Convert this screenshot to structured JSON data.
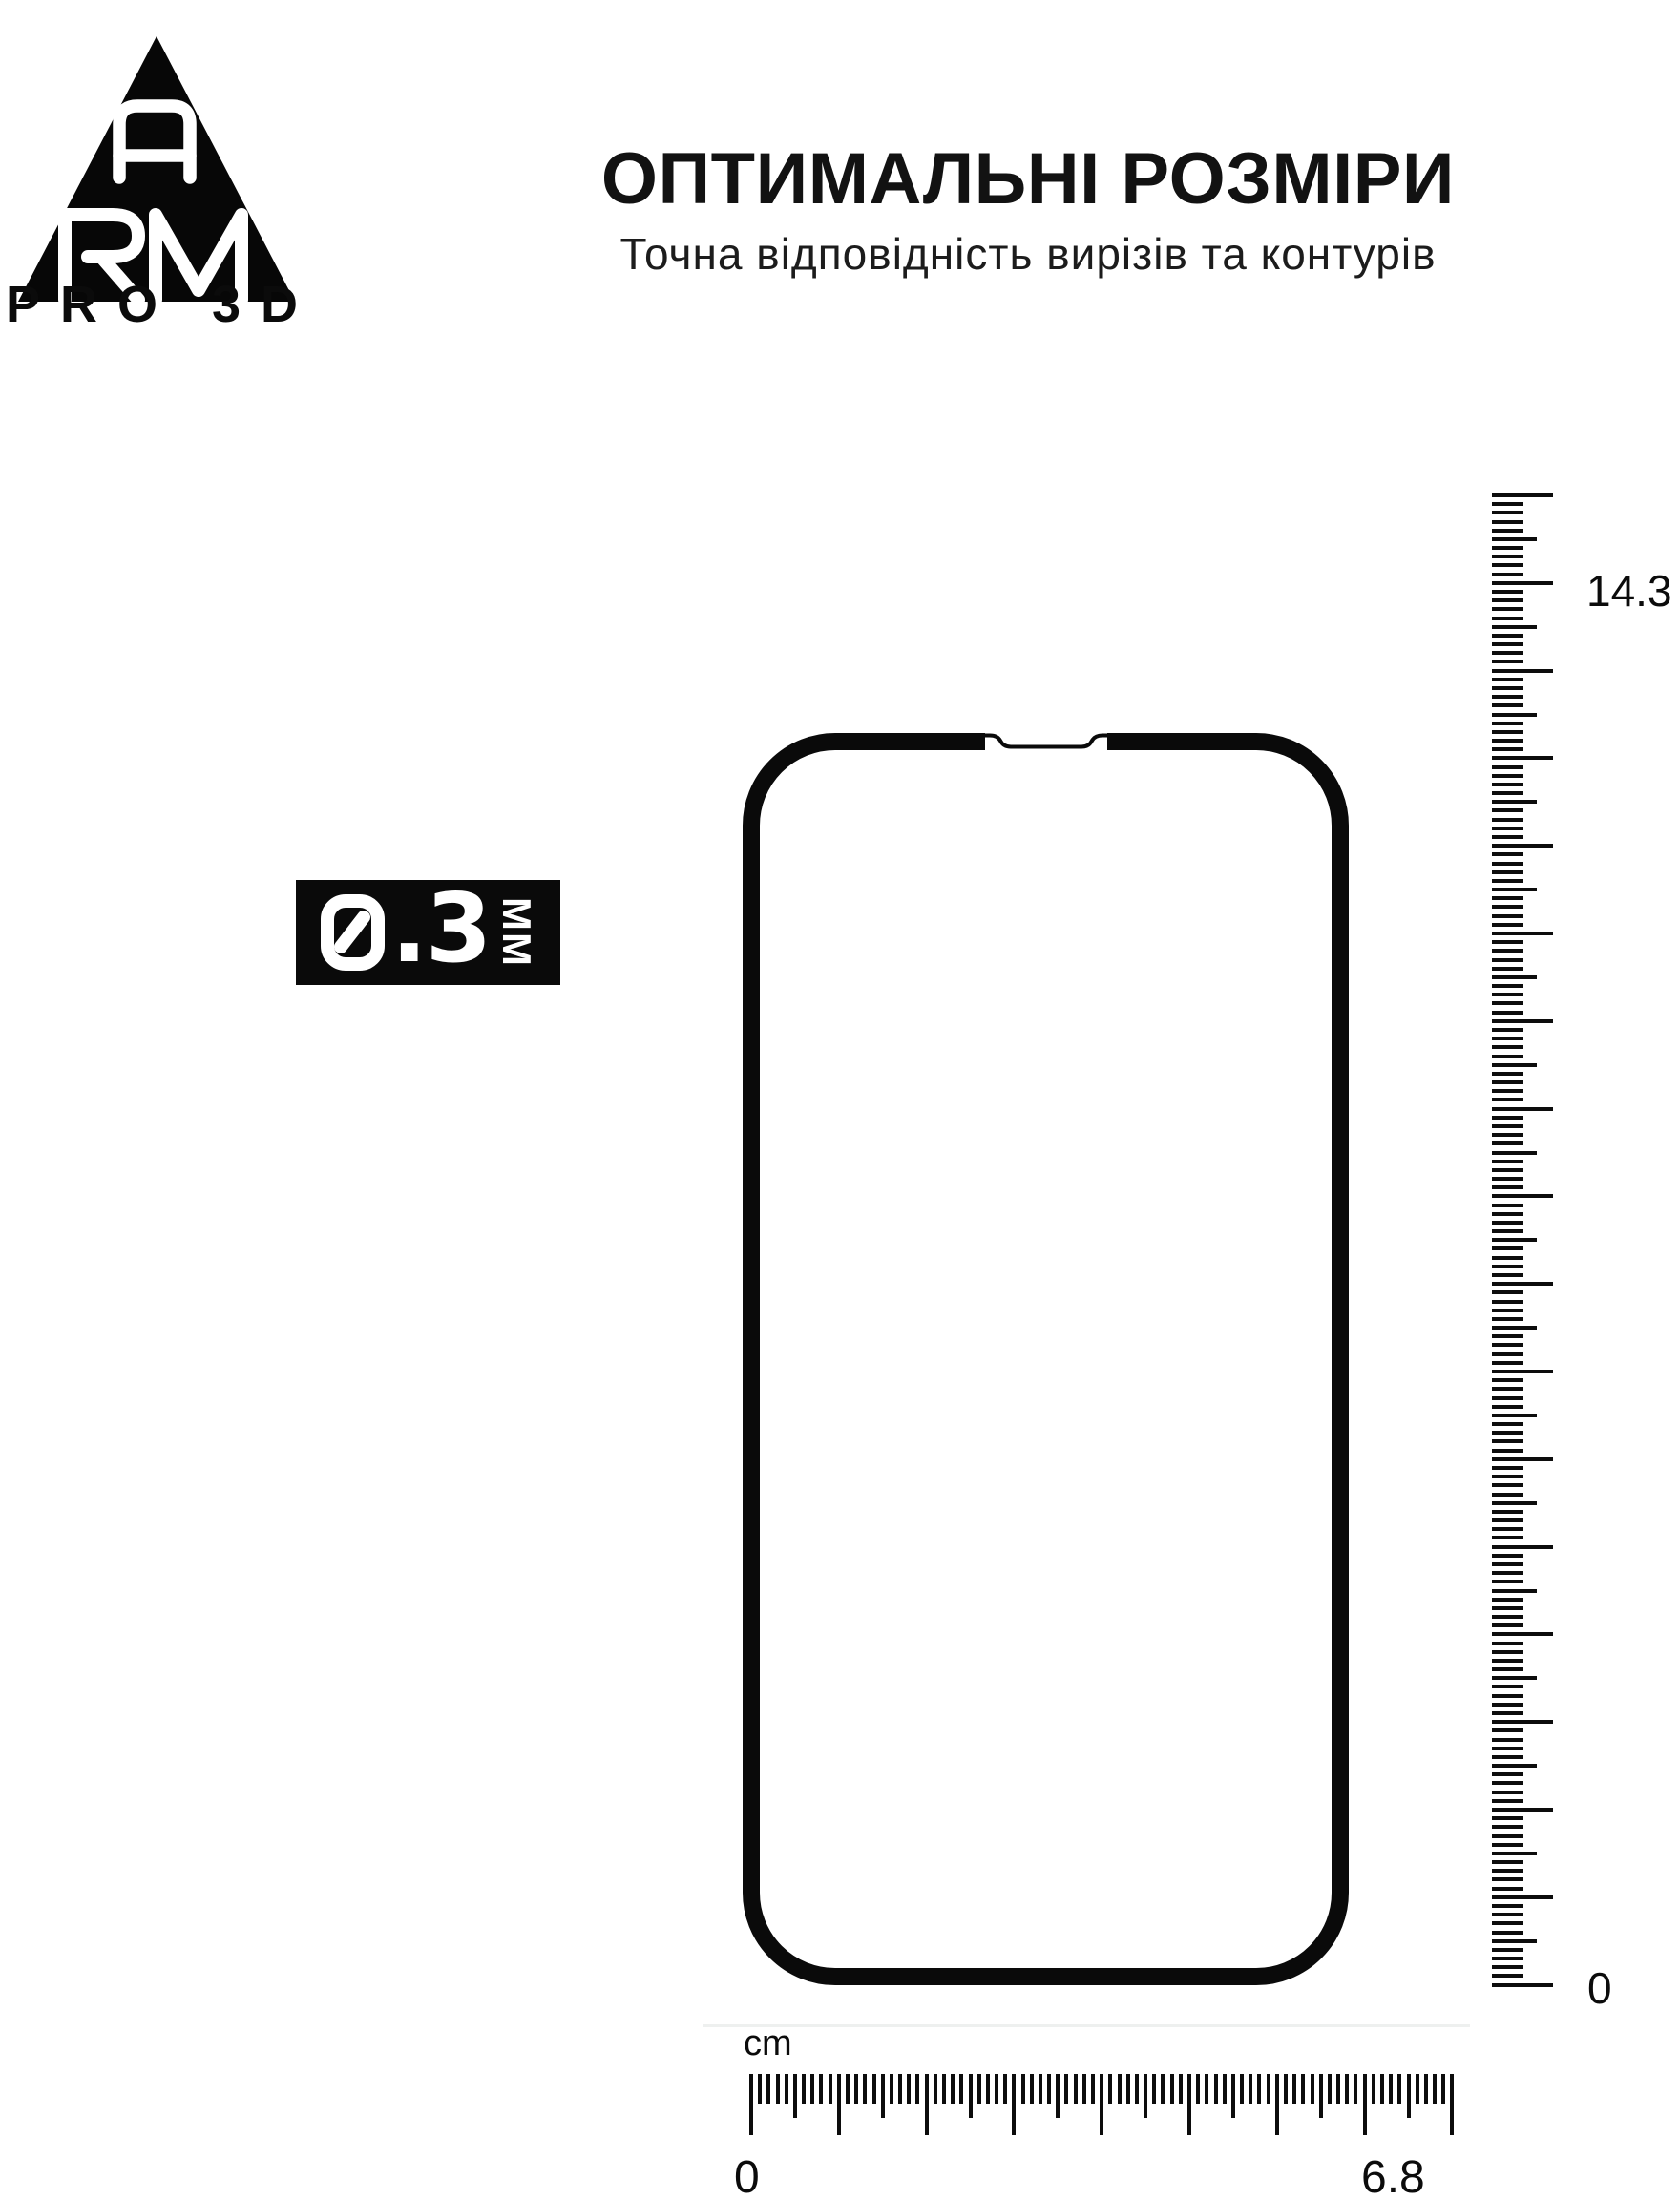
{
  "page": {
    "background": "#ffffff",
    "ink": "#0a0a0a"
  },
  "logo": {
    "monogram_top": "A",
    "monogram_bottom": "RM",
    "caption": "PRO 3D",
    "aria": "ARM PRO 3D logo"
  },
  "header": {
    "title": "ОПТИМАЛЬНІ РОЗМІРИ",
    "subtitle": "Точна відповідність вирізів та контурів"
  },
  "thickness_badge": {
    "value": "0.3",
    "value_fraction": ".3",
    "unit": "ММ",
    "aria": "Товщина 0.3 ММ"
  },
  "vertical_ruler": {
    "max_label": "14.3",
    "zero_label": "0"
  },
  "horizontal_ruler": {
    "unit": "cm",
    "zero_label": "0",
    "max_label": "6.8"
  }
}
